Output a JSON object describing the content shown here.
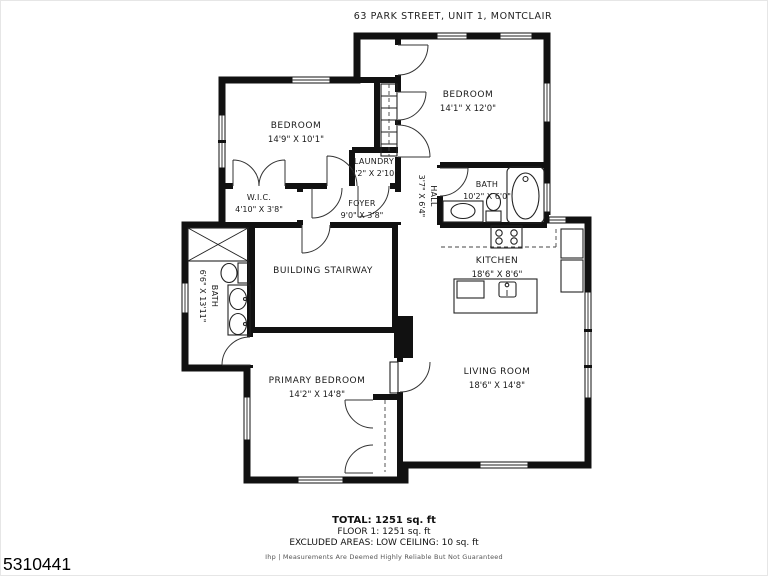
{
  "header": {
    "title": "63 PARK STREET, UNIT 1, MONTCLAIR"
  },
  "rooms": [
    {
      "name": "BEDROOM",
      "dims": "14'9\" X 10'1\""
    },
    {
      "name": "BEDROOM",
      "dims": "14'1\" X 12'0\""
    },
    {
      "name": "LAUNDRY",
      "dims": "3'2\" X 2'10\""
    },
    {
      "name": "HALL",
      "dims": "3'7\" X 6'4\""
    },
    {
      "name": "BATH",
      "dims": "10'2\" X 6'0\""
    },
    {
      "name": "W.I.C.",
      "dims": "4'10\" X 3'8\""
    },
    {
      "name": "FOYER",
      "dims": "9'0\" X 3'8\""
    },
    {
      "name": "KITCHEN",
      "dims": "18'6\" X 8'6\""
    },
    {
      "name": "BUILDING STAIRWAY",
      "dims": ""
    },
    {
      "name": "BATH",
      "dims": "6'6\" X 13'11\""
    },
    {
      "name": "PRIMARY BEDROOM",
      "dims": "14'2\" X 14'8\""
    },
    {
      "name": "LIVING ROOM",
      "dims": "18'6\" X 14'8\""
    }
  ],
  "footer": {
    "total": "TOTAL: 1251 sq. ft",
    "floor": "FLOOR 1: 1251 sq. ft",
    "excluded": "EXCLUDED AREAS: LOW CEILING: 10 sq. ft",
    "disclaimer": "Ihp | Measurements Are Deemed Highly Reliable But Not Guaranteed",
    "listing_number": "5310441"
  },
  "colors": {
    "wall": "#111111",
    "background": "#ffffff"
  }
}
